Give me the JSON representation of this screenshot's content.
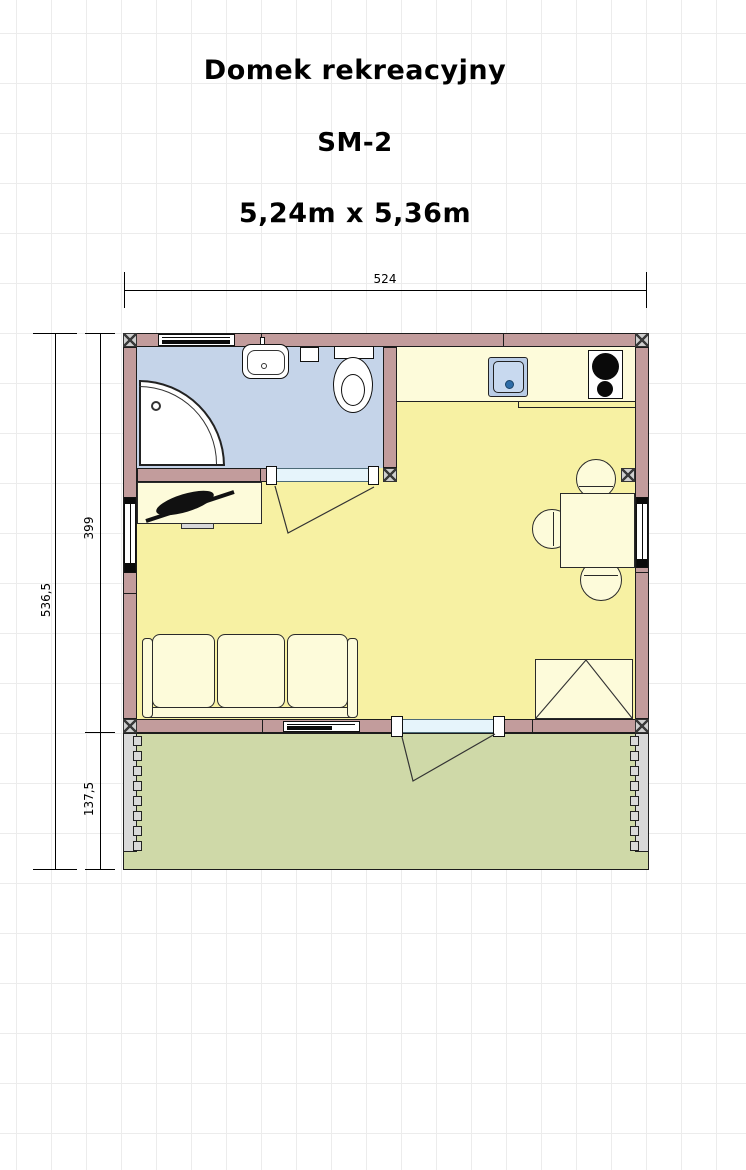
{
  "header": {
    "title": "Domek rekreacyjny",
    "model": "SM-2",
    "dimensions_text": "5,24m x 5,36m"
  },
  "dimension_labels": {
    "width": "524",
    "height_total": "536,5",
    "height_building": "399",
    "depth_terrace": "137,5"
  },
  "colors": {
    "wall": "#c29c9c",
    "bathroom_floor": "#c5d4e9",
    "living_floor": "#f7f1a3",
    "furniture": "#fdfbda",
    "terrace_floor": "#cfd9a8",
    "door_threshold": "#e6f4fb",
    "railing": "#d9d9d9",
    "kitchen_sink": "#b9cce6",
    "sink_drain_dot": "#2f6da8"
  },
  "plan_elements": {
    "rooms": [
      "bathroom",
      "kitchen-area",
      "living-room",
      "terrace"
    ],
    "fixtures": [
      "shower",
      "washbasin",
      "toilet",
      "kitchen-sink",
      "stove",
      "tv-cabinet",
      "sofa",
      "dining-table",
      "chairs",
      "wardrobe",
      "bathroom-door",
      "entry-door",
      "windows",
      "terrace-railing"
    ]
  }
}
